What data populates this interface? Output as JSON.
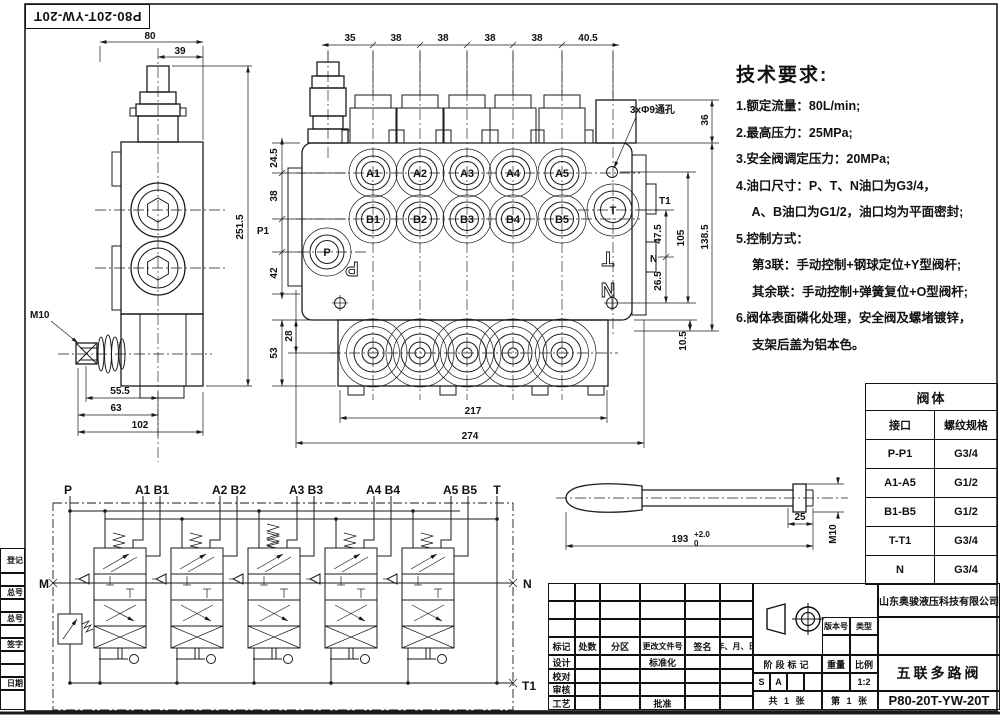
{
  "page": {
    "background": "#ffffff",
    "line_color": "#1a1a1a"
  },
  "part_label_box": {
    "text": "P80-20T-YW-20T"
  },
  "margin_strip": {
    "labels": [
      "登记",
      "总号",
      "总号",
      "签字",
      "日期"
    ]
  },
  "tech_requirements": {
    "title": "技术要求:",
    "lines": [
      "1.额定流量：80L/min;",
      "2.最高压力：25MPa;",
      "3.安全阀调定压力：20MPa;",
      "4.油口尺寸：P、T、N油口为G3/4，",
      "　 A、B油口为G1/2，油口均为平面密封;",
      "5.控制方式：",
      "　 第3联：手动控制+钢球定位+Y型阀杆;",
      "　 其余联：手动控制+弹簧复位+O型阀杆;",
      "6.阀体表面磷化处理，安全阀及螺堵镀锌，",
      "　 支架后盖为铝本色。"
    ]
  },
  "side_view": {
    "dims": {
      "width": "80",
      "half_width": "39",
      "height": "251.5",
      "lever_thread": "M10",
      "lever_offset": "55.5",
      "lever_span": "63",
      "depth": "102"
    }
  },
  "front_view": {
    "top_dims": [
      "35",
      "38",
      "38",
      "38",
      "38",
      "40.5"
    ],
    "left_dims": {
      "a_row": "24.5",
      "b_row": "38",
      "below_p": "42",
      "boss_center": "28",
      "lower_height": "53"
    },
    "right_dims": {
      "top": "36",
      "t_to_n": "47.5",
      "hole_span": "105",
      "body_height": "138.5",
      "n_to_hole": "26.5",
      "plate": "10.5"
    },
    "bottom_dims": {
      "inner": "217",
      "overall": "274"
    },
    "hole_note": "3xΦ9通孔",
    "ports": {
      "a": [
        "A1",
        "A2",
        "A3",
        "A4",
        "A5"
      ],
      "b": [
        "B1",
        "B2",
        "B3",
        "B4",
        "B5"
      ],
      "p": "P",
      "t": "T",
      "p1": "P1",
      "t1": "T1",
      "n": "N"
    },
    "cast_letters": {
      "p": "P",
      "t": "T",
      "n": "N"
    }
  },
  "handle_view": {
    "length": "193",
    "tol_upper": "+2.0",
    "tol_lower": "0",
    "thread_length": "25",
    "thread": "M10"
  },
  "schematic": {
    "top_labels": [
      "P",
      "A1 B1",
      "A2 B2",
      "A3 B3",
      "A4 B4",
      "A5 B5",
      "T"
    ],
    "left_label": "M",
    "right_label": "N",
    "tank_label": "T1"
  },
  "port_table": {
    "title": "阀体",
    "headers": {
      "interface": "接口",
      "spec": "螺纹规格"
    },
    "rows": [
      {
        "port": "P-P1",
        "spec": "G3/4"
      },
      {
        "port": "A1-A5",
        "spec": "G1/2"
      },
      {
        "port": "B1-B5",
        "spec": "G1/2"
      },
      {
        "port": "T-T1",
        "spec": "G3/4"
      },
      {
        "port": "N",
        "spec": "G3/4"
      }
    ]
  },
  "title_block": {
    "company": "山东奥骏液压科技有限公司",
    "product_name": "五联多路阀",
    "model": "P80-20T-YW-20T",
    "rev_headers": [
      "标记",
      "处数",
      "分区",
      "更改文件号",
      "签名",
      "年、月、日"
    ],
    "role_rows": [
      "设计",
      "校对",
      "审核",
      "工艺"
    ],
    "standardization": "标准化",
    "approval": "批准",
    "version_label": "版本号",
    "type_label": "类型",
    "stage_label": "阶段标记",
    "weight_label": "重量",
    "scale_label": "比例",
    "scale_value": "1:2",
    "stage_marks": [
      "S",
      "A"
    ],
    "sheet_total": "共 1 张",
    "sheet_number": "第 1 张"
  }
}
